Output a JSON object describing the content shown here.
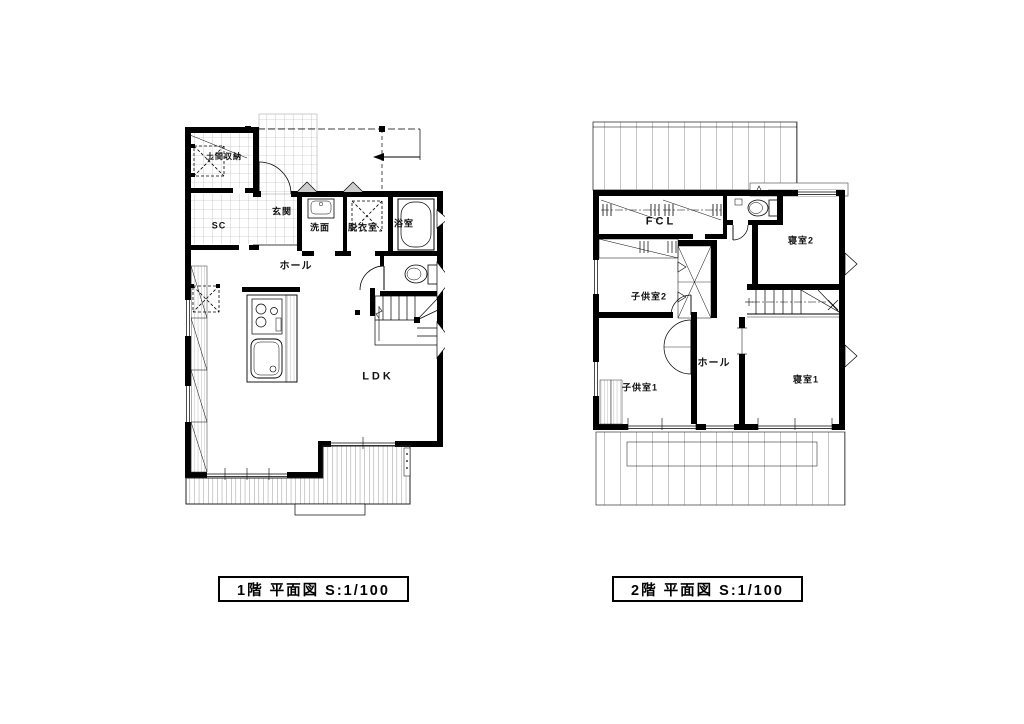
{
  "page": {
    "background": "#ffffff",
    "line_color": "#000000"
  },
  "floor1": {
    "caption": "1階 平面図 S:1/100",
    "rooms": {
      "doma_storage": "土間収納",
      "shoe_closet": "SC",
      "entrance": "玄関",
      "washroom": "洗面",
      "dressing_room": "脱衣室",
      "bathroom": "浴室",
      "hall": "ホール",
      "ldk": "LDK"
    }
  },
  "floor2": {
    "caption": "2階 平面図 S:1/100",
    "rooms": {
      "family_closet": "FCL",
      "kids_room_2": "子供室2",
      "kids_room_1": "子供室1",
      "hall": "ホール",
      "bedroom_2": "寝室2",
      "bedroom_1": "寝室1"
    }
  }
}
